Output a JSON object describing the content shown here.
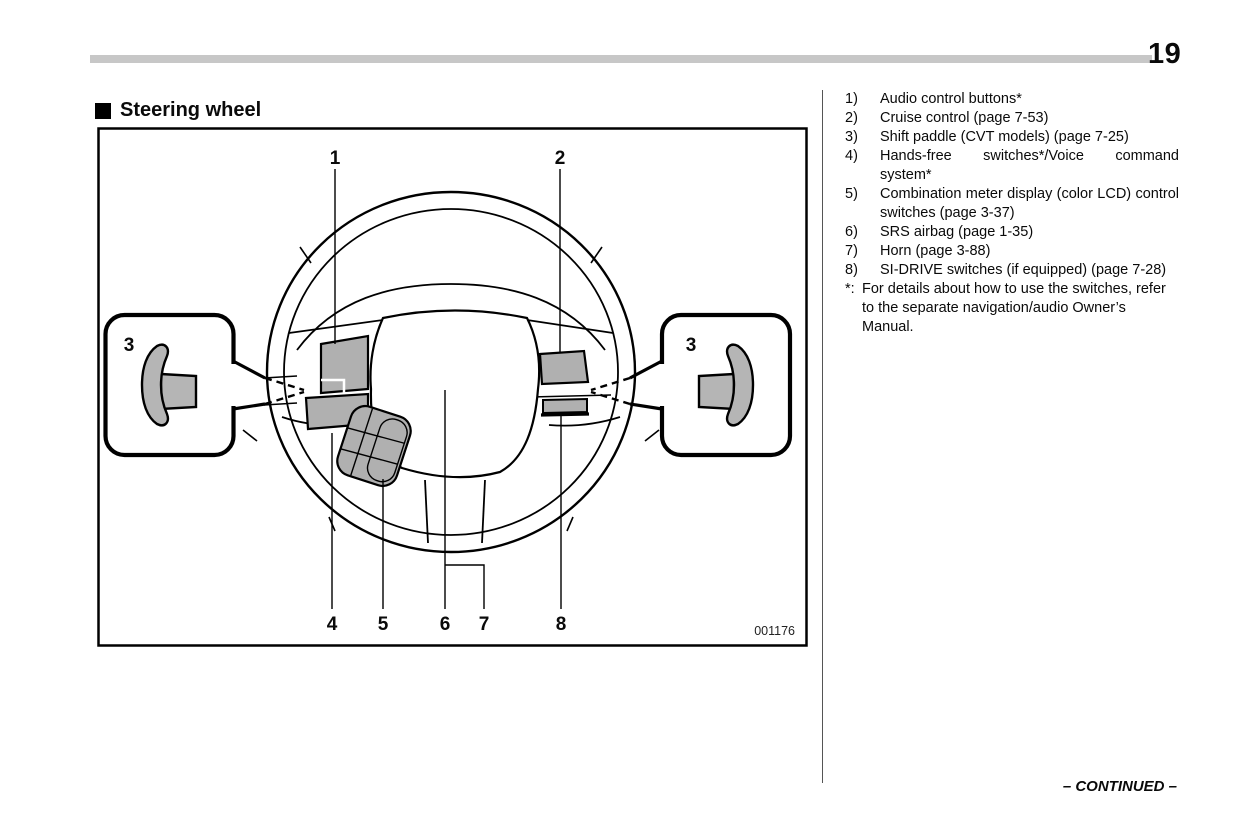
{
  "page": {
    "number": "19",
    "continued": "– CONTINUED –"
  },
  "section": {
    "title": "Steering wheel"
  },
  "figure": {
    "code": "001176",
    "callouts": {
      "n1": "1",
      "n2": "2",
      "n3": "3",
      "n4": "4",
      "n5": "5",
      "n6": "6",
      "n7": "7",
      "n8": "8"
    }
  },
  "legend": {
    "items": [
      {
        "num": "1)",
        "label": "Audio control buttons*"
      },
      {
        "num": "2)",
        "label": "Cruise control (page 7-53)"
      },
      {
        "num": "3)",
        "label": "Shift paddle (CVT models) (page 7-25)"
      },
      {
        "num": "4)",
        "label": "Hands-free switches*/Voice command system*"
      },
      {
        "num": "5)",
        "label": "Combination meter display (color LCD) control switches (page 3-37)"
      },
      {
        "num": "6)",
        "label": "SRS airbag (page 1-35)"
      },
      {
        "num": "7)",
        "label": "Horn (page 3-88)"
      },
      {
        "num": "8)",
        "label": "SI-DRIVE switches (if equipped) (page 7-28)"
      }
    ],
    "footnote": {
      "marker": "*:",
      "text": "For details about how to use the switches, refer to the separate navigation/audio Owner’s Manual."
    }
  },
  "colors": {
    "line": "#000000",
    "panel_gray": "#b0b0b0",
    "rule_gray": "#c7c7c7"
  }
}
